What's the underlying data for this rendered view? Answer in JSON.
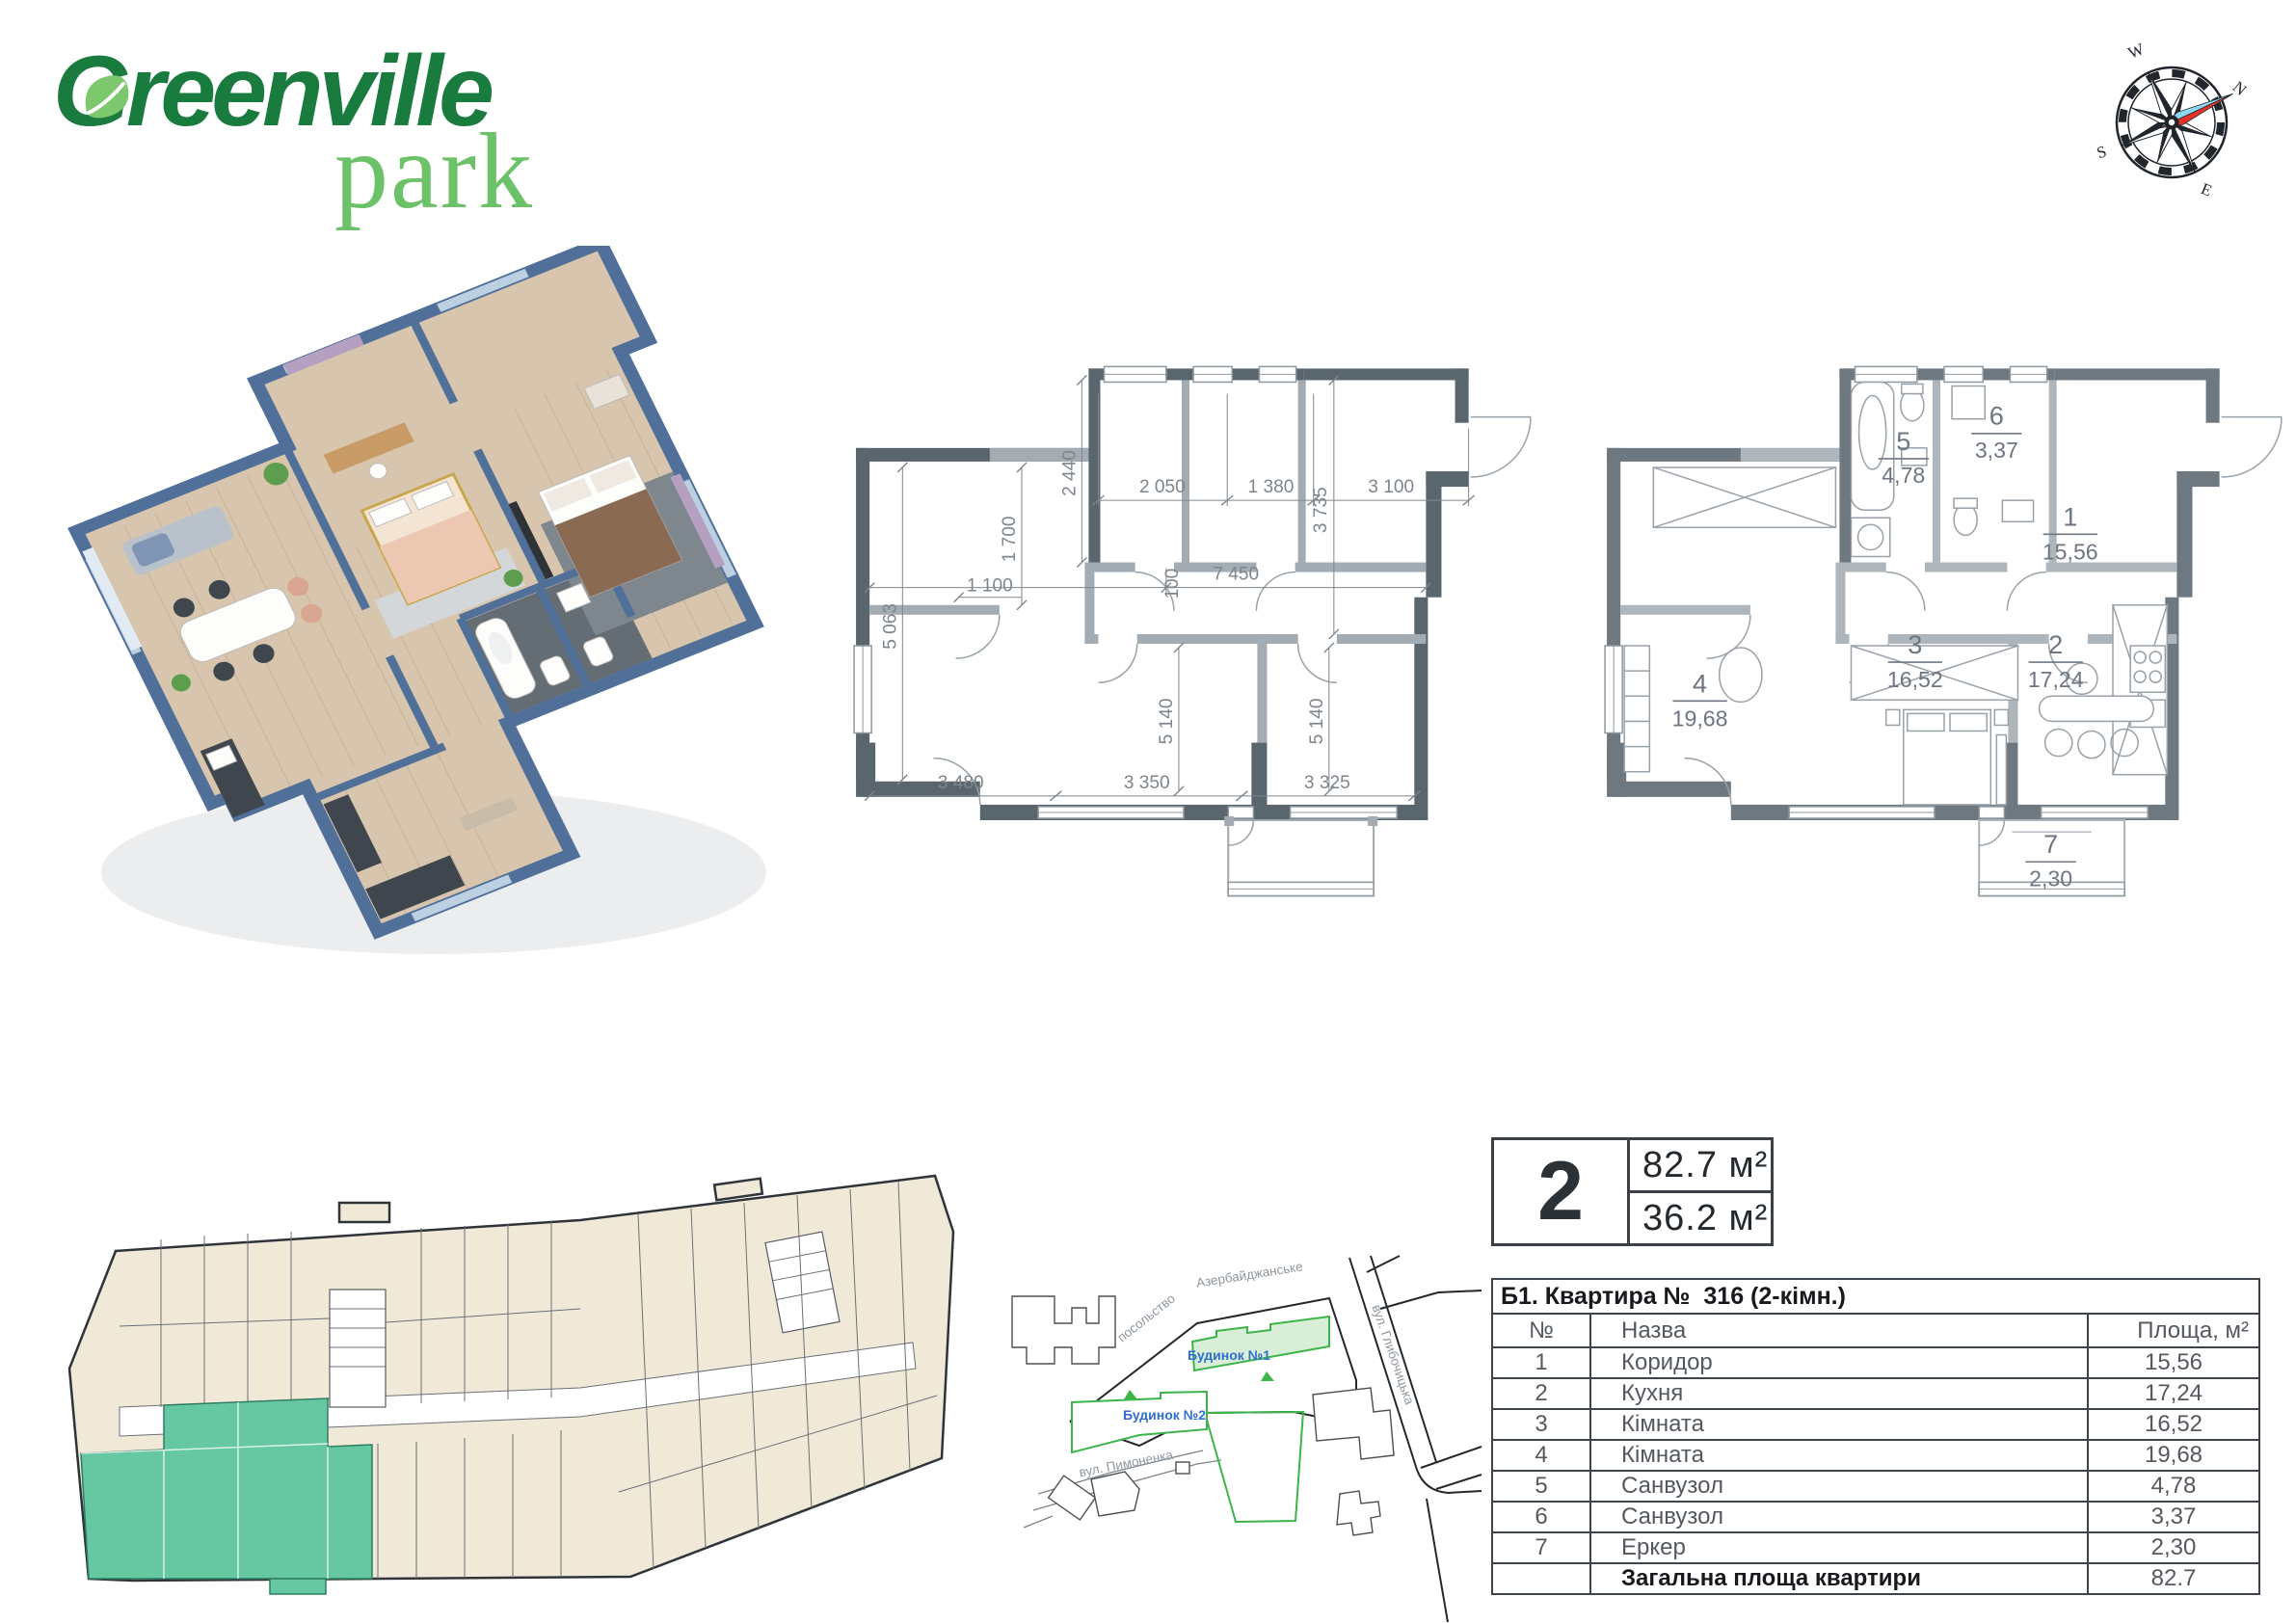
{
  "logo": {
    "title": "Greenville",
    "subtitle": "park",
    "color_dark": "#1a7b3e",
    "color_light": "#6cc268"
  },
  "compass": {
    "n": "N",
    "w": "W",
    "s": "S",
    "e": "E"
  },
  "badge": {
    "rooms_count": "2",
    "area_total": "82.7 м²",
    "area_living": "36.2 м²"
  },
  "table": {
    "title": "Б1. Квартира №  316 (2-кімн.)",
    "columns": {
      "num": "№",
      "name": "Назва",
      "area": "Площа, м²"
    },
    "rows": [
      {
        "num": "1",
        "name": "Коридор",
        "area": "15,56"
      },
      {
        "num": "2",
        "name": "Кухня",
        "area": "17,24"
      },
      {
        "num": "3",
        "name": "Кімната",
        "area": "16,52"
      },
      {
        "num": "4",
        "name": "Кімната",
        "area": "19,68"
      },
      {
        "num": "5",
        "name": "Санвузол",
        "area": "4,78"
      },
      {
        "num": "6",
        "name": "Санвузол",
        "area": "3,37"
      },
      {
        "num": "7",
        "name": "Еркер",
        "area": "2,30"
      }
    ],
    "total_label": "Загальна площа квартири",
    "total_value": "82.7"
  },
  "tech_plan": {
    "dims": {
      "d2050": "2 050",
      "d1380": "1 380",
      "d3100": "3 100",
      "d2440": "2 440",
      "d3735": "3 735",
      "d7450": "7 450",
      "d100": "100",
      "d1700": "1 700",
      "d1100": "1 100",
      "d5063": "5 063",
      "d5140a": "5 140",
      "d5140b": "5 140",
      "d3480": "3 480",
      "d3350": "3 350",
      "d3325": "3 325"
    }
  },
  "room_plan": {
    "rooms": [
      {
        "num": "1",
        "area": "15,56"
      },
      {
        "num": "2",
        "area": "17,24"
      },
      {
        "num": "3",
        "area": "16,52"
      },
      {
        "num": "4",
        "area": "19,68"
      },
      {
        "num": "5",
        "area": "4,78"
      },
      {
        "num": "6",
        "area": "3,37"
      },
      {
        "num": "7",
        "area": "2,30"
      }
    ]
  },
  "site_map": {
    "street_embassy": "посольство",
    "street_azerbaijani": "Азербайджанське",
    "street_right": "вул. Глибочицька",
    "street_bottom": "вул. Пимоненка",
    "building_1": "Будинок №1",
    "building_2": "Будинок №2",
    "accent_green": "#3cb54a",
    "label_blue": "#2f6fd0"
  },
  "colors": {
    "highlight_teal": "#65c8a3",
    "unit_beige": "#f1e9d8",
    "wall_dark": "#5a666e"
  }
}
